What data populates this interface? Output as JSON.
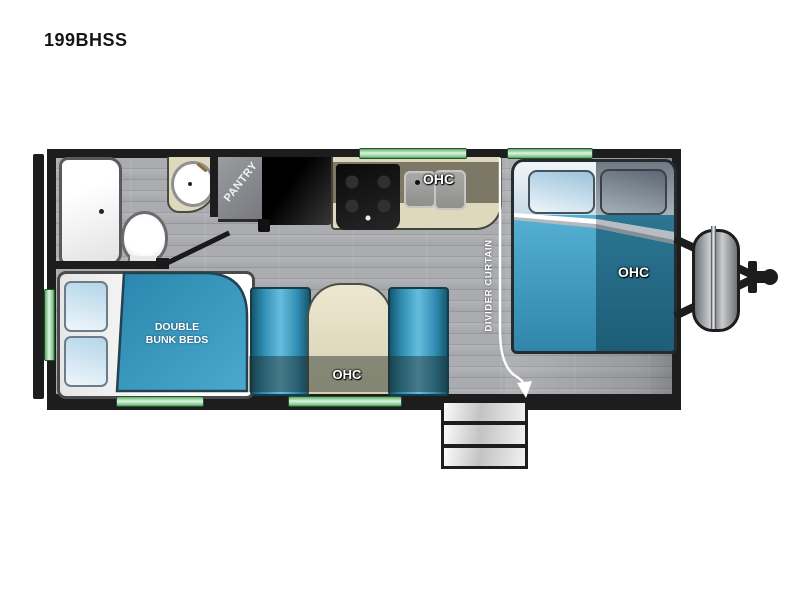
{
  "title": "199BHSS",
  "floorplan": {
    "pantry_label": "PANTRY",
    "kitchen_ohc_label": "OHC",
    "bed_ohc_label": "OHC",
    "dinette_ohc_label": "OHC",
    "bunk_label_line1": "DOUBLE",
    "bunk_label_line2": "BUNK BEDS",
    "divider_curtain_label": "DIVIDER CURTAIN"
  },
  "colors": {
    "wall_black": "#1d1d1d",
    "floor_gray": "#a5a6aa",
    "accent_blue": "#3093bd",
    "dark_teal": "#1d5d77",
    "counter_tan": "#ded8bc",
    "cabinet_shadow_olive": "#7d7866",
    "window_green": "#8ed29a",
    "label_white": "#ffffff"
  }
}
